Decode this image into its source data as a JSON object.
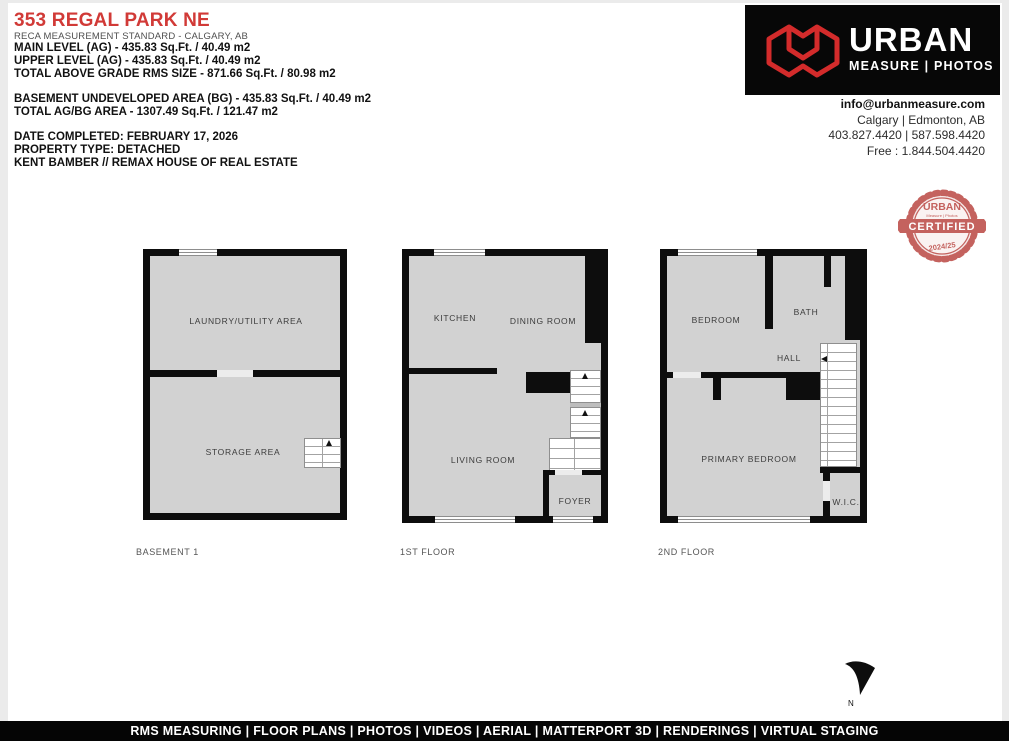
{
  "header": {
    "title": "353 REGAL PARK NE",
    "subtitle": "RECA MEASUREMENT STANDARD - CALGARY, AB",
    "lines1": {
      "0": "MAIN LEVEL (AG) - 435.83 Sq.Ft. / 40.49 m2",
      "1": "UPPER LEVEL (AG) - 435.83 Sq.Ft. / 40.49 m2",
      "2": "TOTAL ABOVE GRADE RMS SIZE - 871.66 Sq.Ft. / 80.98 m2"
    },
    "lines2": {
      "0": "BASEMENT UNDEVELOPED AREA (BG) - 435.83 Sq.Ft. / 40.49 m2",
      "1": "TOTAL AG/BG AREA - 1307.49 Sq.Ft. / 121.47 m2"
    },
    "lines3": {
      "0": "DATE COMPLETED: FEBRUARY 17, 2026",
      "1": "PROPERTY TYPE: DETACHED",
      "2": "KENT BAMBER // REMAX HOUSE OF REAL ESTATE"
    }
  },
  "brand": {
    "name": "URBAN",
    "tagline": "MEASURE | PHOTOS",
    "email": "info@urbanmeasure.com",
    "locations": "Calgary | Edmonton, AB",
    "phones": "403.827.4420 | 587.598.4420",
    "tollfree": "Free : 1.844.504.4420",
    "accent": "#d32b2b"
  },
  "badge": {
    "top": "URBAN",
    "small": "Measure | Photos",
    "middle": "CERTIFIED",
    "bottom": "2024/25",
    "color": "#c4625e"
  },
  "plans": {
    "basement": {
      "label": "BASEMENT 1",
      "rooms": {
        "laundry": "LAUNDRY/UTILITY AREA",
        "storage": "STORAGE AREA"
      }
    },
    "first": {
      "label": "1ST FLOOR",
      "rooms": {
        "kitchen": "KITCHEN",
        "dining": "DINING ROOM",
        "living": "LIVING ROOM",
        "foyer": "FOYER"
      }
    },
    "second": {
      "label": "2ND FLOOR",
      "rooms": {
        "bedroom": "BEDROOM",
        "bath": "BATH",
        "hall": "HALL",
        "primary": "PRIMARY BEDROOM",
        "wic": "W.I.C."
      }
    }
  },
  "compass": {
    "label": "N"
  },
  "footer": {
    "text": "RMS MEASURING | FLOOR PLANS | PHOTOS | VIDEOS | AERIAL | MATTERPORT 3D | RENDERINGS | VIRTUAL STAGING"
  }
}
